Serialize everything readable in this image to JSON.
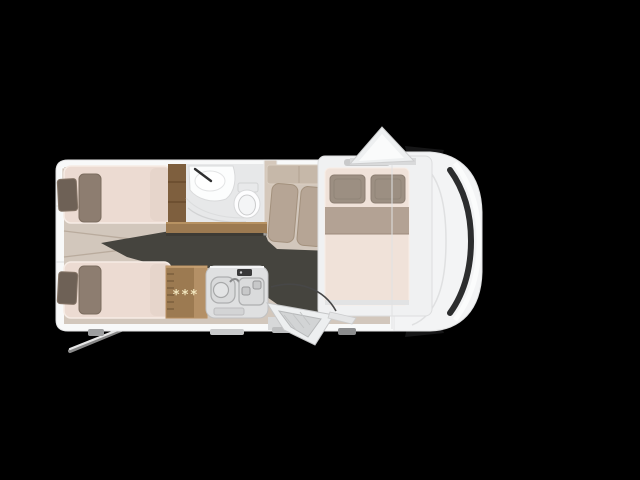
{
  "scene": {
    "subject": "Motorhome floor plan, top-down view on black background",
    "visible_areas": [
      "rear twin single beds",
      "washroom with sink and toilet",
      "wardrobe-fridge cabinet with 3-star freezer rating",
      "kitchen block with sink and two-burner hob",
      "dinette bench seats",
      "drop-down double bed over front lounge",
      "driver cab with windscreen",
      "open entry door with window",
      "open roof hatch"
    ]
  },
  "fridge": {
    "star_rating": "***"
  },
  "palette": {
    "background": "#000000",
    "body_white": "#f3f4f5",
    "wall_white": "#f8f9f9",
    "floor_beige": "#d2c7bc",
    "carpet_dark": "#45443e",
    "mattress_cream": "#ecdbd2",
    "mattress_front": "#f0e2d9",
    "cushion_brown": "#8d7d70",
    "cushion_dark": "#6e6156",
    "pillow_gray": "#9c8f82",
    "blanket_tan": "#b3a294",
    "seat_tan": "#b6a595",
    "backrest_tan": "#c6b8a9",
    "wood": "#9c7a51",
    "bath_wall": "#d5c8bb",
    "counter_gray": "#dfe0e1",
    "bath_floor": "#e7e8e9",
    "fixture_white": "#fcfdfd",
    "windshield": "#2c2d2e",
    "star_cream": "#f1e5bd",
    "door_white": "#edeff0"
  }
}
